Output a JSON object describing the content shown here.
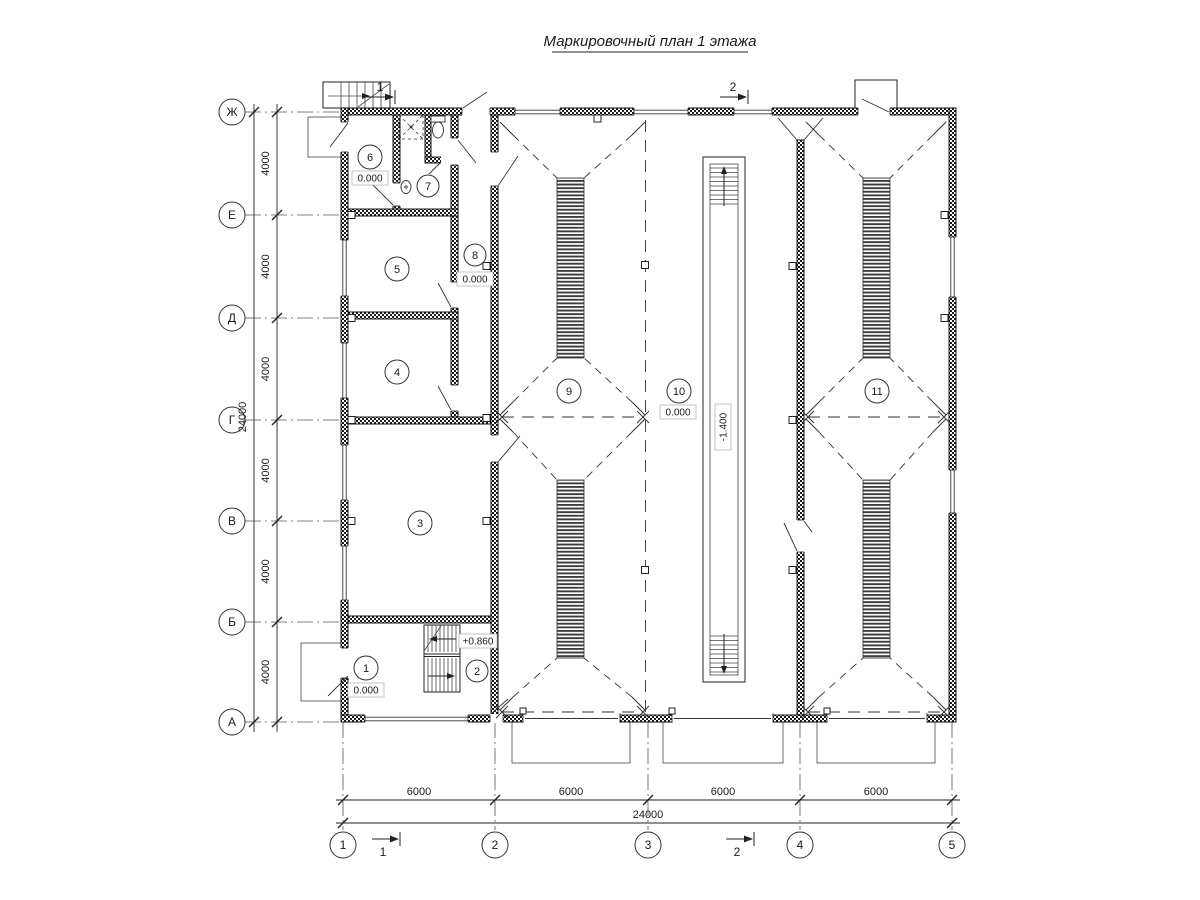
{
  "title": "Маркировочный план 1 этажа",
  "axes": {
    "rows": [
      {
        "label": "Ж"
      },
      {
        "label": "Е"
      },
      {
        "label": "Д"
      },
      {
        "label": "Г"
      },
      {
        "label": "В"
      },
      {
        "label": "Б"
      },
      {
        "label": "А"
      }
    ],
    "cols": [
      {
        "label": "1"
      },
      {
        "label": "2"
      },
      {
        "label": "3"
      },
      {
        "label": "4"
      },
      {
        "label": "5"
      }
    ]
  },
  "dimensions": {
    "left_bays": [
      "4000",
      "4000",
      "4000",
      "4000",
      "4000",
      "4000"
    ],
    "left_total": "24000",
    "bottom_bays": [
      "6000",
      "6000",
      "6000",
      "6000"
    ],
    "bottom_total": "24000"
  },
  "rooms": [
    {
      "number": "1"
    },
    {
      "number": "2"
    },
    {
      "number": "3"
    },
    {
      "number": "4"
    },
    {
      "number": "5"
    },
    {
      "number": "6"
    },
    {
      "number": "7"
    },
    {
      "number": "8"
    },
    {
      "number": "9"
    },
    {
      "number": "10"
    },
    {
      "number": "11"
    }
  ],
  "marks": {
    "room1": "0.000",
    "room2": "+0.860",
    "room6": "0.000",
    "room8": "0.000",
    "room10": "0.000",
    "pit": "-1.400"
  },
  "sections": {
    "s1": "1",
    "s2": "2"
  }
}
